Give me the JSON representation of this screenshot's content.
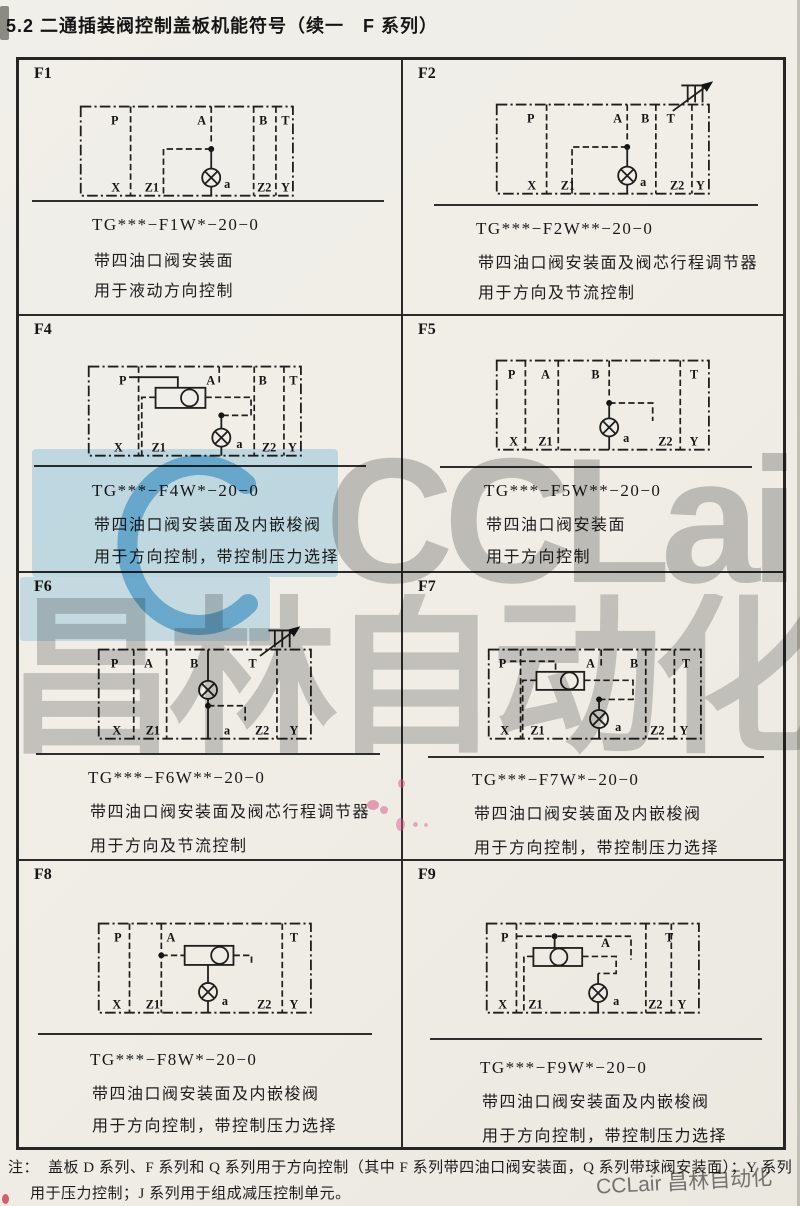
{
  "page": {
    "title": "5.2 二通插装阀控制盖板机能符号（续一　F 系列）",
    "note_label": "注：",
    "note_line1": "盖板 D 系列、F 系列和 Q 系列用于方向控制（其中 F 系列带四油口阀安装面，Q 系列带球阀安装面）；Y 系列",
    "note_line2": "用于压力控制；J 系列用于组成减压控制单元。"
  },
  "watermark": {
    "logo_text": "CCLair",
    "cn_text": "昌林自动化",
    "corner_text": "CCLair 昌林自动化",
    "blue": "#abd9f2",
    "gray": "#8d8d8d"
  },
  "cells": [
    {
      "id": "F1",
      "code": "TG***−F1W*−20−0",
      "desc1": "带四油口阀安装面",
      "desc2": "用于液动方向控制",
      "ports": {
        "top": [
          "P",
          "A",
          "B",
          "T"
        ],
        "bottom": [
          "X",
          "Z1",
          "a",
          "Z2",
          "Y"
        ]
      }
    },
    {
      "id": "F2",
      "code": "TG***−F2W**−20−0",
      "desc1": "带四油口阀安装面及阀芯行程调节器",
      "desc2": "用于方向及节流控制",
      "ports": {
        "top": [
          "P",
          "A",
          "B",
          "T"
        ],
        "bottom": [
          "X",
          "Z1",
          "a",
          "Z2",
          "Y"
        ]
      }
    },
    {
      "id": "F4",
      "code": "TG***−F4W*−20−0",
      "desc1": "带四油口阀安装面及内嵌梭阀",
      "desc2": "用于方向控制，带控制压力选择",
      "ports": {
        "top": [
          "P",
          "A",
          "B",
          "T"
        ],
        "bottom": [
          "X",
          "Z1",
          "a",
          "Z2",
          "Y"
        ]
      }
    },
    {
      "id": "F5",
      "code": "TG***−F5W**−20−0",
      "desc1": "带四油口阀安装面",
      "desc2": "用于方向控制",
      "ports": {
        "top": [
          "P",
          "A",
          "B",
          "T"
        ],
        "bottom": [
          "X",
          "Z1",
          "a",
          "Z2",
          "Y"
        ]
      }
    },
    {
      "id": "F6",
      "code": "TG***−F6W**−20−0",
      "desc1": "带四油口阀安装面及阀芯行程调节器",
      "desc2": "用于方向及节流控制",
      "ports": {
        "top": [
          "P",
          "A",
          "B",
          "T"
        ],
        "bottom": [
          "X",
          "Z1",
          "a",
          "Z2",
          "Y"
        ]
      }
    },
    {
      "id": "F7",
      "code": "TG***−F7W*−20−0",
      "desc1": "带四油口阀安装面及内嵌梭阀",
      "desc2": "用于方向控制，带控制压力选择",
      "ports": {
        "top": [
          "P",
          "A",
          "B",
          "T"
        ],
        "bottom": [
          "X",
          "Z1",
          "a",
          "Z2",
          "Y"
        ]
      }
    },
    {
      "id": "F8",
      "code": "TG***−F8W*−20−0",
      "desc1": "带四油口阀安装面及内嵌梭阀",
      "desc2": "用于方向控制，带控制压力选择",
      "ports": {
        "top": [
          "P",
          "A",
          "T"
        ],
        "bottom": [
          "X",
          "Z1",
          "a",
          "Z2",
          "Y"
        ]
      }
    },
    {
      "id": "F9",
      "code": "TG***−F9W*−20−0",
      "desc1": "带四油口阀安装面及内嵌梭阀",
      "desc2": "用于方向控制，带控制压力选择",
      "ports": {
        "top": [
          "P",
          "A",
          "T"
        ],
        "bottom": [
          "X",
          "Z1",
          "a",
          "Z2",
          "Y"
        ]
      }
    }
  ]
}
